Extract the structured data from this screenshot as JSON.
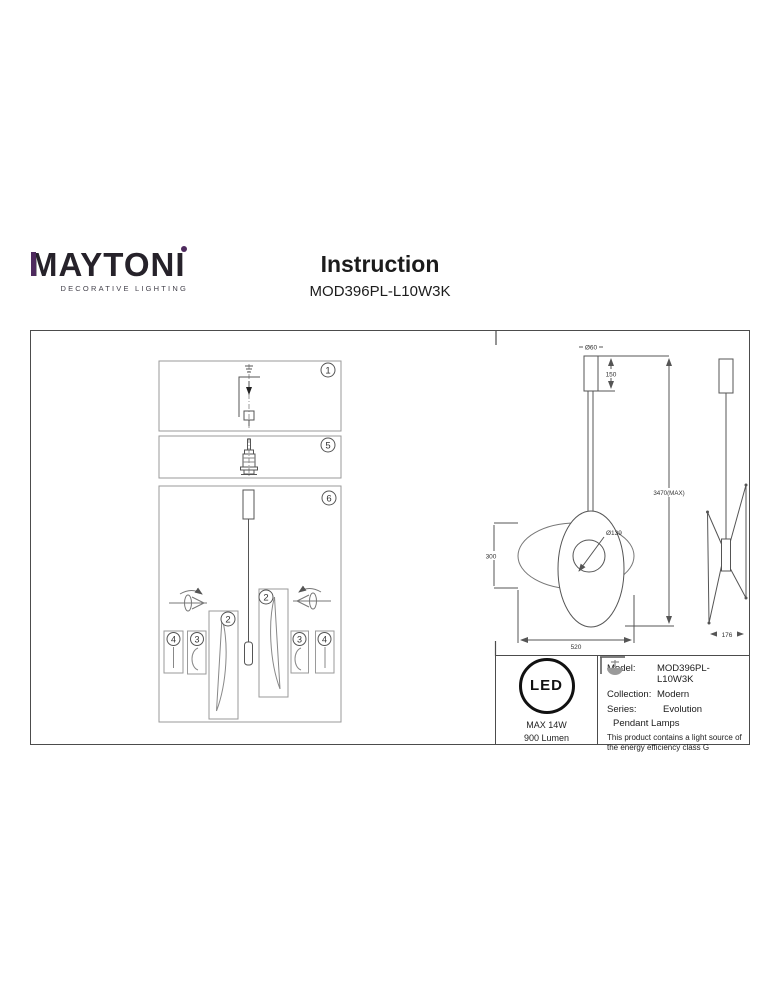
{
  "brand": {
    "name": "MAYTONI",
    "tagline": "DECORATIVE LIGHTING",
    "accent_color": "#4e2a5e"
  },
  "header": {
    "title": "Instruction",
    "model": "MOD396PL-L10W3K"
  },
  "assembly_steps": {
    "panel_top": "1",
    "panel_middle": "5",
    "panel_bottom": "6",
    "shade_left": "2",
    "shade_right": "2",
    "diffuser_left": "3",
    "diffuser_right": "3",
    "rod_left": "4",
    "rod_right": "4"
  },
  "dimensions": {
    "canopy_diameter": "Ø60",
    "canopy_height": "150",
    "max_suspension": "3470(MAX)",
    "hole_diameter": "Ø139",
    "shade_height": "300",
    "total_width": "520",
    "side_depth": "176"
  },
  "spec_box": {
    "led_text": "LED",
    "max_power": "MAX 14W",
    "luminous_flux": "900 Lumen",
    "model_label": "Model:",
    "model_value": "MOD396PL-L10W3K",
    "collection_label": "Collection:",
    "collection_value": "Modern",
    "series_label": "Series:",
    "series_value": "Evolution",
    "category": "Pendant Lamps",
    "energy_note": "This product contains a light source of the energy efficiency class G"
  }
}
